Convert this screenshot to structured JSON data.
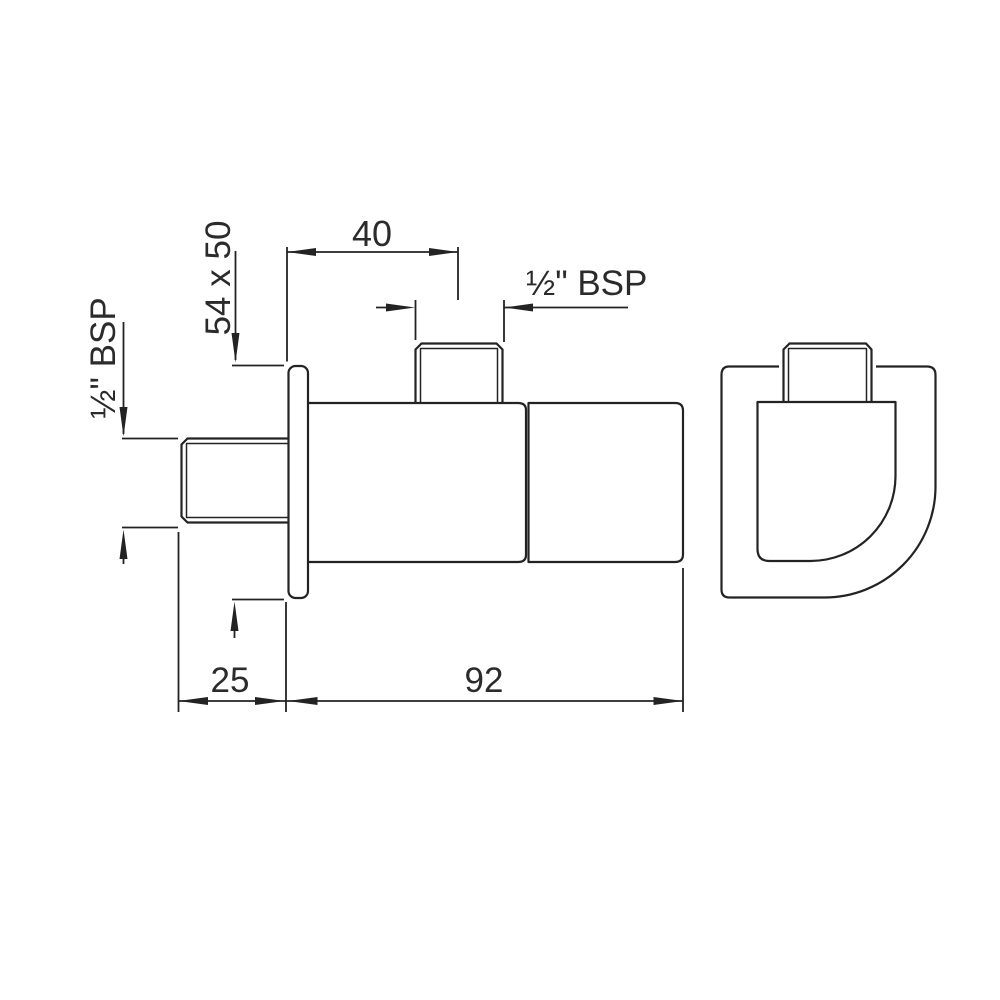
{
  "colors": {
    "line": "#232323",
    "text": "#2b2b2b",
    "background": "#ffffff"
  },
  "drawing": {
    "type": "technical-dimension-drawing",
    "labels": {
      "dim_40": "40",
      "dim_54x50": "54 x 50",
      "bsp_top": "½\" BSP",
      "bsp_left": "½\" BSP",
      "dim_25": "25",
      "dim_92": "92"
    }
  }
}
